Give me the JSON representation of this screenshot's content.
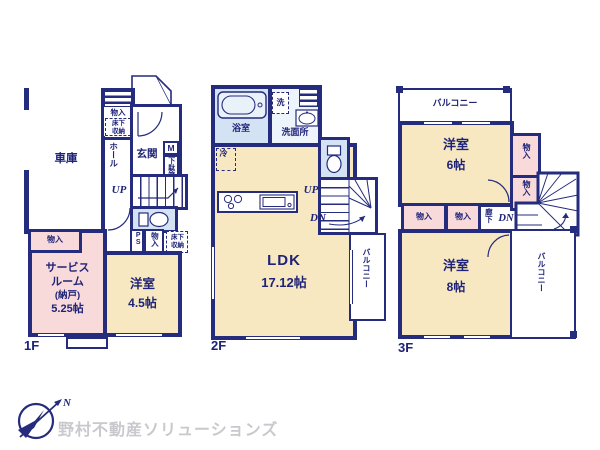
{
  "colors": {
    "wall_navy": "#252b7d",
    "text_navy": "#1f2378",
    "room_cream": "#f7e8c2",
    "room_pink": "#f8dadb",
    "room_blue": "#d3e3f3",
    "logo_gray": "#c9c8cd"
  },
  "floor1": {
    "label": "1F",
    "garage": "車庫",
    "closet_top": "物入",
    "underfloor_top": "床下収納",
    "hall": "ホール",
    "entrance": "玄関",
    "shoebox_m": "M",
    "shoebox": "下駄箱",
    "up": "UP",
    "ps": "PS",
    "closet_mid": "物入",
    "underfloor_mid": "床下収納",
    "service_closet": "物入",
    "service_room": [
      "サービス",
      "ルーム",
      "(納戸)",
      "5.25帖"
    ],
    "bedroom": [
      "洋室",
      "4.5帖"
    ]
  },
  "floor2": {
    "label": "2F",
    "bath": "浴室",
    "washer": "洗",
    "washroom": "洗面所",
    "fridge": "冷",
    "up": "UP",
    "dn": "DN",
    "ldk": [
      "LDK",
      "17.12帖"
    ],
    "balcony": "バルコニー"
  },
  "floor3": {
    "label": "3F",
    "balcony_top": "バルコニー",
    "bedroom6": [
      "洋室",
      "6帖"
    ],
    "closet_r1": "物入",
    "closet_r2": "物入",
    "closet_b1": "物入",
    "closet_b2": "物入",
    "hallway": "廊下",
    "dn": "DN",
    "bedroom8": [
      "洋室",
      "8帖"
    ],
    "balcony_side": "バルコニー"
  },
  "footer": {
    "north": "N",
    "company": "野村不動産ソリューションズ"
  }
}
